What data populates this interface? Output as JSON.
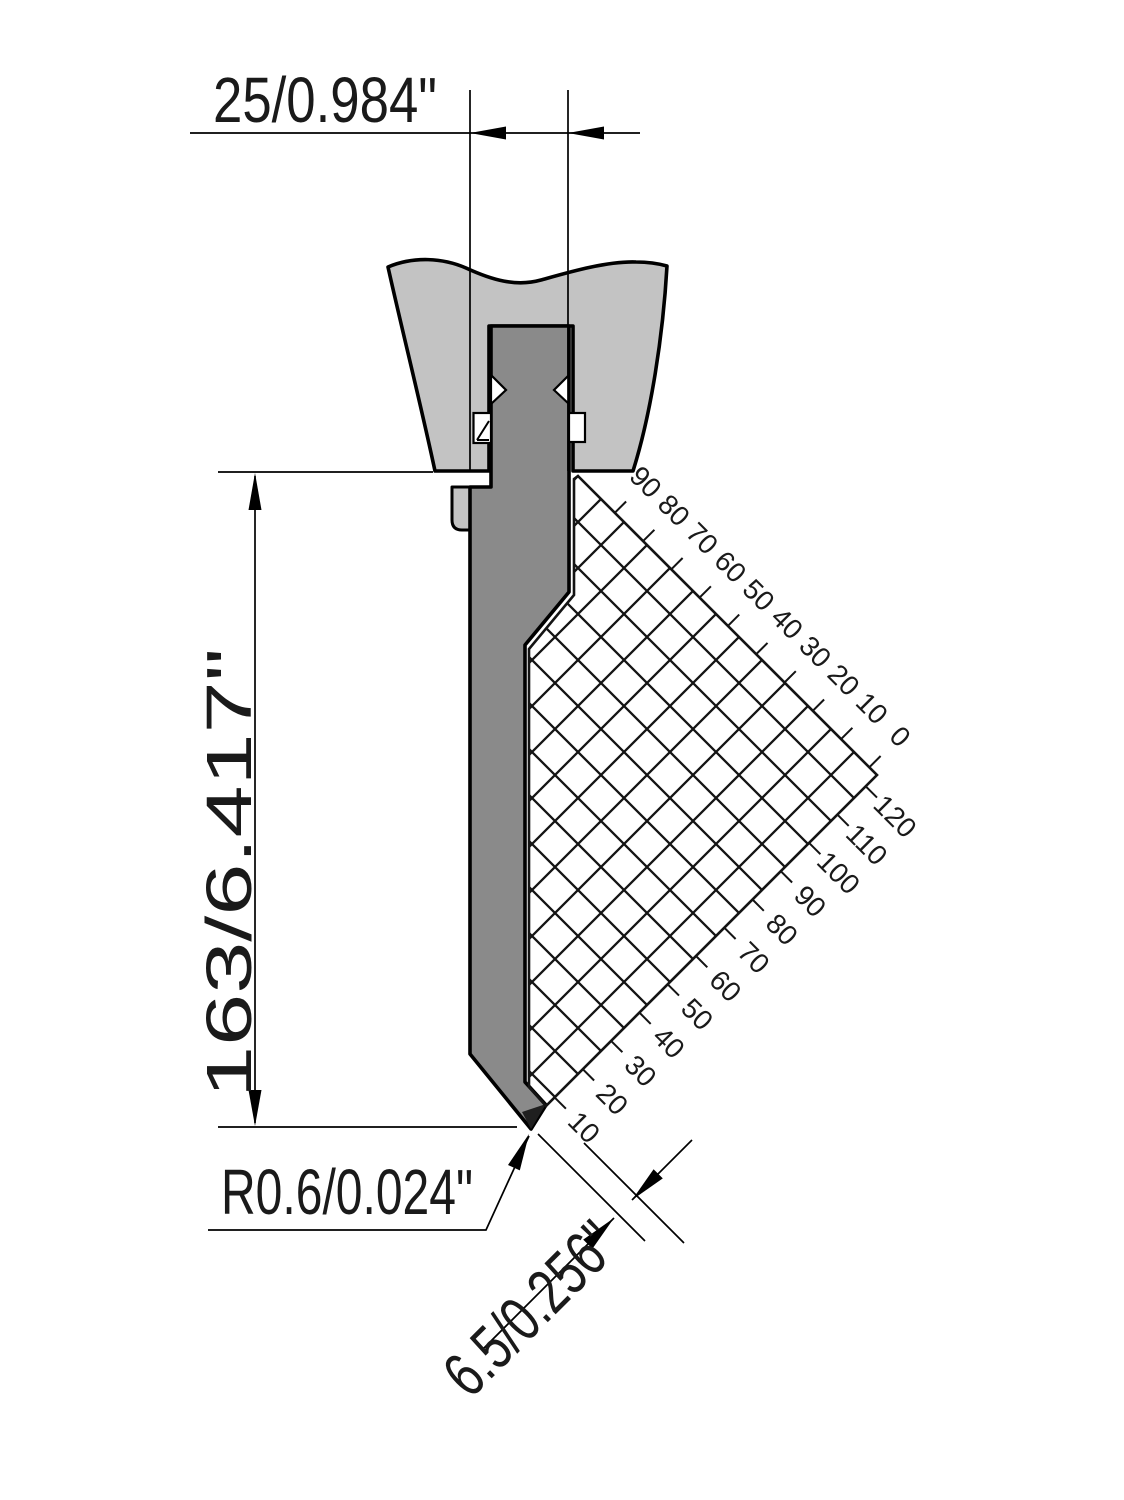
{
  "dimensions": {
    "width_label": "25/0.984\"",
    "height_label": "163/6.417\"",
    "tip_radius_label": "R0.6/0.024\"",
    "tip_flank_label": "6.5/0.256\""
  },
  "grid": {
    "top_scale": [
      "90",
      "80",
      "70",
      "60",
      "50",
      "40",
      "30",
      "20",
      "10",
      "0"
    ],
    "bottom_scale": [
      "120",
      "110",
      "100",
      "90",
      "80",
      "70",
      "60",
      "50",
      "40",
      "30",
      "20",
      "10"
    ]
  },
  "colors": {
    "background": "#ffffff",
    "clamp_fill": "#c3c3c3",
    "punch_fill": "#8a8a8a",
    "tip_fill": "#1f1f1f",
    "line": "#000000"
  }
}
